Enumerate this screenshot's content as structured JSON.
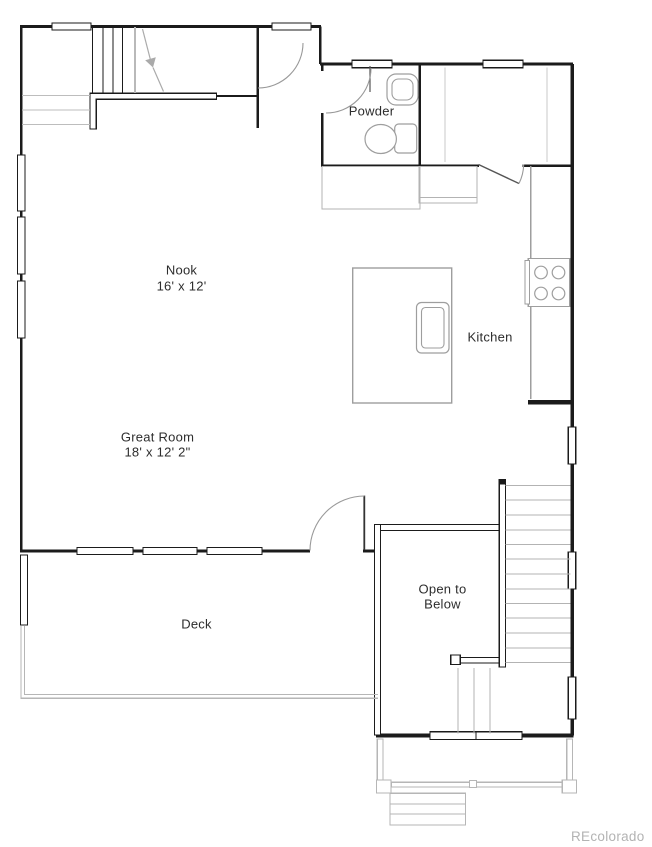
{
  "plan": {
    "rooms": [
      {
        "key": "powder",
        "name": "Powder",
        "dims": ""
      },
      {
        "key": "nook",
        "name": "Nook",
        "dims": "16' x 12'"
      },
      {
        "key": "kitchen",
        "name": "Kitchen",
        "dims": ""
      },
      {
        "key": "great_room",
        "name": "Great Room",
        "dims": "18' x 12' 2\""
      },
      {
        "key": "open_to_below",
        "name": "Open to Below",
        "dims": ""
      },
      {
        "key": "deck",
        "name": "Deck",
        "dims": ""
      }
    ],
    "fixtures": [
      "toilet",
      "vanity-sink",
      "range-cooktop",
      "kitchen-island",
      "island-sink",
      "stairs-up",
      "stairs-down",
      "refrigerator-counter"
    ],
    "watermark": "REcolorado",
    "colors": {
      "wall": "#1b1b1b",
      "fixture": "#9e9e9e",
      "stair_tread": "#b3b3b3",
      "site": "#b6b6b6",
      "label": "#2d2d2d",
      "watermark": "#b3b3b3"
    }
  }
}
